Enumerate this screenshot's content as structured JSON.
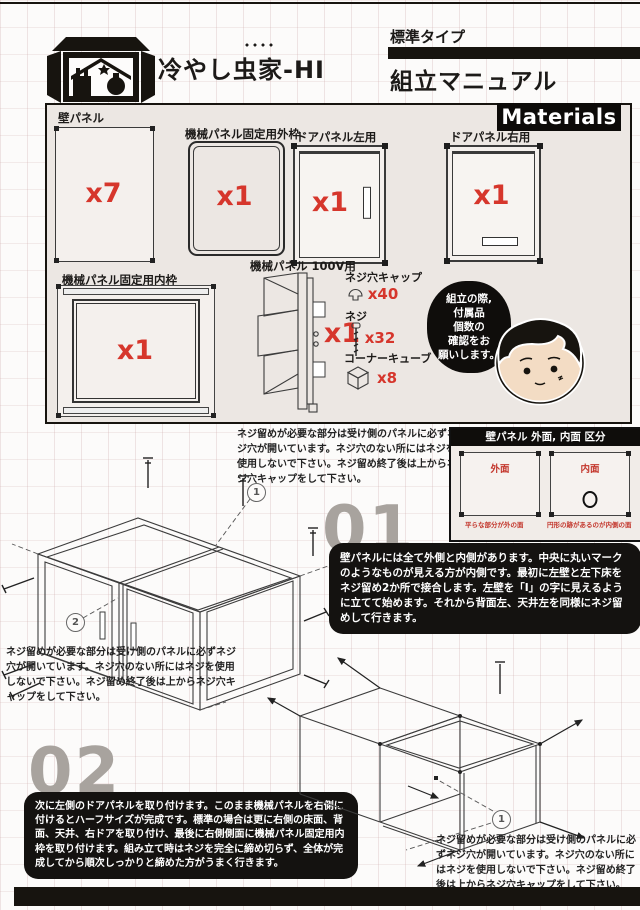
{
  "header": {
    "brand": "冷やし虫家-HI",
    "type_label": "標準タイプ",
    "manual_title": "組立マニュアル"
  },
  "materials": {
    "section_title": "Materials",
    "parts": [
      {
        "label": "壁パネル",
        "count": "x7"
      },
      {
        "label": "機械パネル固定用外枠",
        "count": "x1"
      },
      {
        "label": "ドアパネル左用",
        "count": "x1"
      },
      {
        "label": "ドアパネル右用",
        "count": "x1"
      },
      {
        "label": "機械パネル固定用内枠",
        "count": "x1"
      },
      {
        "label": "機械パネル 100V用",
        "count": "x1"
      }
    ],
    "hardware": [
      {
        "label": "ネジ穴キャップ",
        "count": "x40"
      },
      {
        "label": "ネジ",
        "count": "x32"
      },
      {
        "label": "コーナーキューブ",
        "count": "x8"
      }
    ],
    "bubble_text": "組立の際,\n付属品\n個数の\n確認をお\n願いします。"
  },
  "panel_guide": {
    "title": "壁パネル 外面, 内面 区分",
    "outer_label": "外面",
    "outer_caption": "平らな部分が外の面",
    "inner_label": "内面",
    "inner_caption": "円形の跡があるのが内側の面"
  },
  "screw_note": "ネジ留めが必要な部分は受け側のパネルに必ずネジ穴が開いています。ネジ穴のない所にはネジを使用しないで下さい。ネジ留め終了後は上からネジ穴キャップをして下さい。",
  "steps": [
    {
      "number": "01",
      "text": "壁パネルには全て外側と内側があります。中央に丸いマークのようなものが見える方が内側です。最初に左壁と左下床をネジ留め2か所で接合します。左壁を「I」の字に見えるように立てて始めます。それから背面左、天井左を同様にネジ留めして行きます。"
    },
    {
      "number": "02",
      "text": "次に左側のドアパネルを取り付けます。このまま機械パネルを右側に付けるとハーフサイズが完成です。標準の場合は更に右側の床面、背面、天井、右ドアを取り付け、最後に右側側面に機械パネル固定用内枠を取り付けます。組み立て時はネジを完全に締め切らず、全体が完成してから順次しっかりと締めた方がうまく行きます。"
    }
  ],
  "callouts": {
    "one": "1",
    "two": "2"
  },
  "colors": {
    "accent_red": "#d6362c",
    "ink": "#17140f",
    "step_gray": "#a8a39e"
  }
}
